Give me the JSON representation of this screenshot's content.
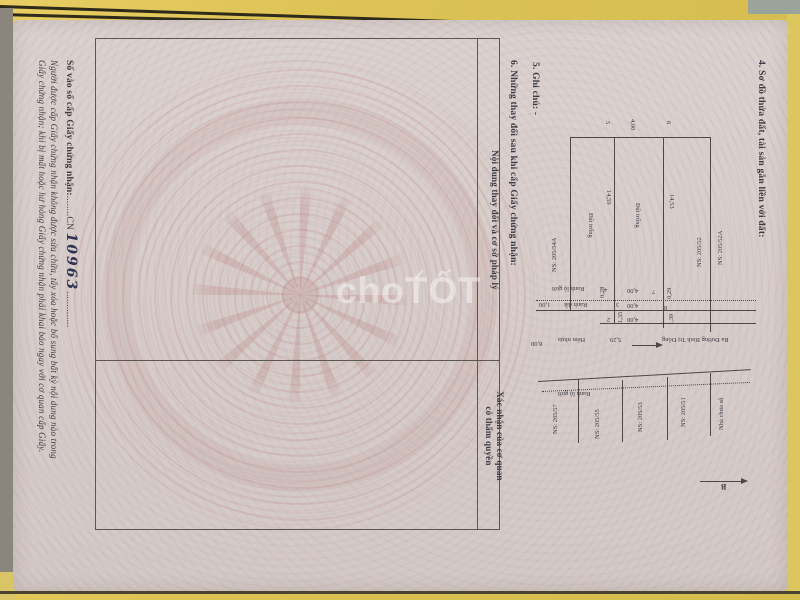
{
  "watermark": {
    "text": "choTỐT",
    "check": "✓"
  },
  "certificate": {
    "section4_title": "4. Sơ đồ thửa đất, tài sản gắn liền với đất:",
    "section5_title": "5. Ghi chú: -",
    "section6_title": "6. Những thay đổi sau khi cấp Giấy chứng nhận:",
    "table": {
      "col_content": "Nội dung thay đổi và cơ sở pháp lý",
      "col_confirm_line1": "Xác nhận của cơ quan",
      "col_confirm_line2": "có thẩm quyền"
    },
    "issue_label": "Số vào sổ cấp Giấy chứng nhận:",
    "issue_dots_before": "........",
    "issue_prefix": "CN",
    "issue_number": "10963",
    "issue_dots_after": "..............",
    "warning_line1": "Người được cấp Giấy chứng nhận không được sửa chữa, tẩy xóa hoặc bổ sung bất kỳ nội dung nào trong",
    "warning_line2": "Giấy chứng nhận; khi bị mất hoặc hư hỏng Giấy chứng nhận phải khai báo ngay với cơ quan cấp Giấy."
  },
  "diagram": {
    "labels": [
      {
        "text": "5",
        "x": 611,
        "y": 121,
        "rot": 90
      },
      {
        "text": "4,00",
        "x": 636,
        "y": 119,
        "rot": 90
      },
      {
        "text": "6",
        "x": 672,
        "y": 121,
        "rot": 90
      },
      {
        "text": "14,59",
        "x": 612,
        "y": 190,
        "rot": 90
      },
      {
        "text": "14,53",
        "x": 675,
        "y": 194,
        "rot": 90
      },
      {
        "text": "Đất trống",
        "x": 641,
        "y": 203,
        "rot": 90
      },
      {
        "text": "Đất trống",
        "x": 594,
        "y": 213,
        "rot": 90
      },
      {
        "text": "NS: 205/54A",
        "x": 551,
        "y": 272,
        "rot": 270
      },
      {
        "text": "NS: 205/52",
        "x": 696,
        "y": 267,
        "rot": 270
      },
      {
        "text": "NS: 205/52A",
        "x": 717,
        "y": 265,
        "rot": 270
      },
      {
        "text": "0,28",
        "x": 599,
        "y": 298,
        "rot": 270
      },
      {
        "text": "1,35",
        "x": 617,
        "y": 323,
        "rot": 270
      },
      {
        "text": "0,29",
        "x": 666,
        "y": 299,
        "rot": 270
      },
      {
        "text": "1,39",
        "x": 668,
        "y": 325,
        "rot": 270
      },
      {
        "text": "NS: 205/57",
        "x": 552,
        "y": 434,
        "rot": 270
      },
      {
        "text": "NS: 205/55",
        "x": 594,
        "y": 439,
        "rot": 270
      },
      {
        "text": "NS: 205/53",
        "x": 637,
        "y": 432,
        "rot": 270
      },
      {
        "text": "NS: 205/51",
        "x": 680,
        "y": 427,
        "rot": 270
      },
      {
        "text": "Nhà chưa số",
        "x": 718,
        "y": 430,
        "rot": 270
      },
      {
        "text": "4",
        "x": 604,
        "y": 286,
        "rot": 180
      },
      {
        "text": "3",
        "x": 616,
        "y": 301,
        "rot": 180
      },
      {
        "text": "2",
        "x": 607,
        "y": 316,
        "rot": 180
      },
      {
        "text": "7",
        "x": 652,
        "y": 288,
        "rot": 180
      },
      {
        "text": "8",
        "x": 664,
        "y": 304,
        "rot": 180
      },
      {
        "text": "1",
        "x": 662,
        "y": 320,
        "rot": 180
      },
      {
        "text": "4,00",
        "x": 627,
        "y": 287,
        "rot": 180
      },
      {
        "text": "4,00",
        "x": 627,
        "y": 302,
        "rot": 180
      },
      {
        "text": "4,00",
        "x": 627,
        "y": 316,
        "rot": 180
      },
      {
        "text": "Ranh lộ giới",
        "x": 552,
        "y": 285,
        "rot": 180
      },
      {
        "text": "1,00",
        "x": 539,
        "y": 301,
        "rot": 180
      },
      {
        "text": "Ranh đất",
        "x": 564,
        "y": 301,
        "rot": 180
      },
      {
        "text": "Hẻm nhựa",
        "x": 558,
        "y": 336,
        "rot": 180
      },
      {
        "text": "5,29",
        "x": 610,
        "y": 336,
        "rot": 180
      },
      {
        "text": "8,00",
        "x": 531,
        "y": 340,
        "rot": 180
      },
      {
        "text": "Ra Đường Bình Trị Đông",
        "x": 662,
        "y": 336,
        "rot": 180
      },
      {
        "text": "Ranh lộ giới",
        "x": 558,
        "y": 390,
        "rot": 180
      },
      {
        "text": "B",
        "x": 721,
        "y": 482,
        "rot": 180,
        "size": 8,
        "bold": true
      }
    ],
    "lines": [
      {
        "x": 570,
        "y": 137,
        "w": 140,
        "h": 1
      },
      {
        "x": 570,
        "y": 137,
        "w": 1,
        "h": 173
      },
      {
        "x": 614,
        "y": 137,
        "w": 1,
        "h": 187
      },
      {
        "x": 663,
        "y": 137,
        "w": 1,
        "h": 191
      },
      {
        "x": 710,
        "y": 137,
        "w": 1,
        "h": 195
      },
      {
        "x": 536,
        "y": 300,
        "w": 220,
        "h": 1,
        "dotted": true
      },
      {
        "x": 536,
        "y": 310,
        "w": 220,
        "h": 1
      },
      {
        "x": 600,
        "y": 323,
        "w": 156,
        "h": 1
      },
      {
        "x": 538,
        "y": 381,
        "w": 213,
        "h": 1,
        "deg": -3.2
      },
      {
        "x": 542,
        "y": 391,
        "w": 208,
        "h": 1,
        "dotted": true,
        "deg": -2.5
      },
      {
        "x": 578,
        "y": 379,
        "w": 1,
        "h": 64
      },
      {
        "x": 622,
        "y": 380,
        "w": 1,
        "h": 62
      },
      {
        "x": 667,
        "y": 377,
        "w": 1,
        "h": 63
      },
      {
        "x": 710,
        "y": 373,
        "w": 1,
        "h": 63
      },
      {
        "x": 700,
        "y": 481,
        "w": 42,
        "h": 1
      },
      {
        "x": 632,
        "y": 345,
        "w": 25,
        "h": 1
      }
    ]
  }
}
